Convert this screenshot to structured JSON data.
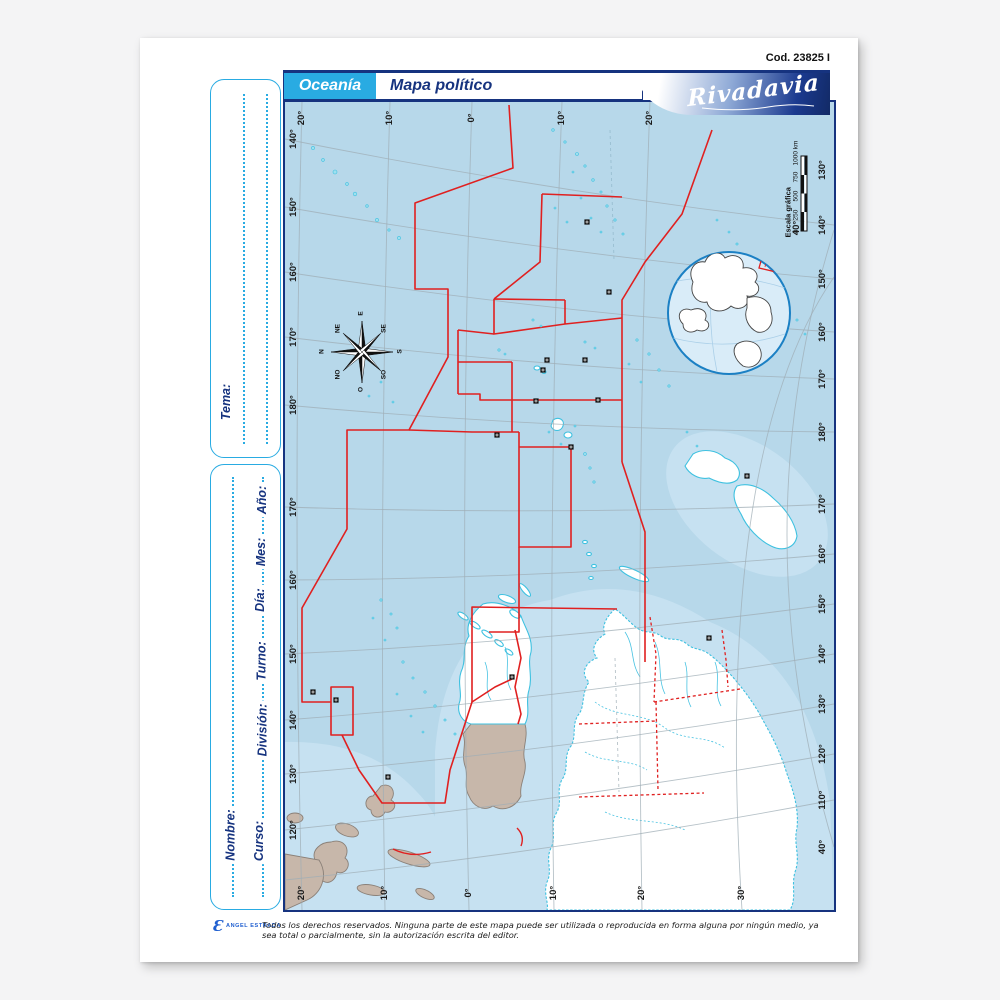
{
  "page": {
    "code": "Cod. 23825 I"
  },
  "header": {
    "region": "Oceanía",
    "title": "Mapa político",
    "brand": "Rivadavia"
  },
  "sidebar": {
    "tema": "Tema:",
    "ano": "Año:",
    "mes": "Mes:",
    "dia": "Día:",
    "turno": "Turno:",
    "division": "División:",
    "nombre": "Nombre:",
    "curso": "Curso:"
  },
  "map": {
    "edge_labels": {
      "top": [
        "20°",
        "10°",
        "0°",
        "10°",
        "20°"
      ],
      "bottom": [
        "20°",
        "10°",
        "0°",
        "10°",
        "20°",
        "30°"
      ],
      "left": [
        "140°",
        "150°",
        "160°",
        "170°",
        "180°",
        "170°",
        "160°",
        "150°",
        "140°",
        "130°",
        "120°"
      ],
      "right": [
        "130°",
        "140°",
        "150°",
        "160°",
        "170°",
        "180°",
        "170°",
        "160°",
        "150°",
        "140°",
        "130°",
        "120°",
        "110°",
        "40°"
      ],
      "interior": [
        "40°"
      ]
    },
    "scale_bar": {
      "title": "Escala gráfica",
      "ticks": [
        "0",
        "250",
        "500",
        "750",
        "1000 km"
      ]
    },
    "compass": {
      "n": "N",
      "ne": "NE",
      "e": "E",
      "se": "SE",
      "s": "S",
      "so": "SO",
      "o": "O",
      "no": "NO"
    }
  },
  "footer": {
    "publisher": "ANGEL ESTRADA",
    "copyright": "Todos los derechos reservados. Ninguna parte de este mapa puede ser utilizada o reproducida en forma alguna por ningún medio, ya sea total o parcialmente, sin la autorización escrita del editor."
  },
  "colors": {
    "brand_cyan": "#29abe2",
    "navy": "#16337f",
    "border_red": "#e02020",
    "ocean": "#b7d8ea",
    "coast_cyan": "#3ec1e0",
    "asia_land": "#c7b7aa"
  }
}
